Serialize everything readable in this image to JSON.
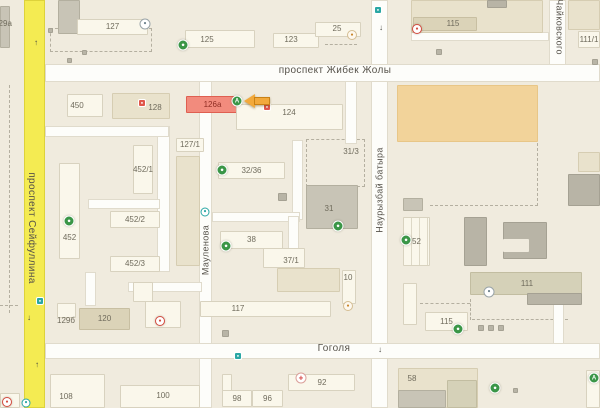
{
  "map": {
    "colors": {
      "background": "#f0ebde",
      "road_white": "#fdfdfa",
      "road_yellow": "#f4eb52",
      "building_white": "#faf7eb",
      "building_beige": "#e9e2cc",
      "building_gray": "#c8c4b6",
      "market_orange": "#f2d39a",
      "highlight_building": "#f28b7d",
      "highlight_arrow": "#f2a93b",
      "poi_green": "#3a9647",
      "poi_red": "#d44b3f",
      "poi_teal": "#2aa7a4"
    },
    "streets": [
      {
        "id": "zhibek-zholy",
        "text": "проспект Жибек Жолы",
        "x": 335,
        "y": 71,
        "orient": "h",
        "size": 10
      },
      {
        "id": "gogolya",
        "text": "Гоголя",
        "x": 334,
        "y": 349,
        "orient": "h",
        "size": 10
      },
      {
        "id": "seyfullina",
        "text": "проспект Сейфуллина",
        "x": 31,
        "y": 228,
        "orient": "v-down",
        "size": 10
      },
      {
        "id": "maulenova",
        "text": "Мауленова",
        "x": 206,
        "y": 250,
        "orient": "v-up",
        "size": 9
      },
      {
        "id": "nauryzbai-batyra",
        "text": "Наурызбай батыра",
        "x": 380,
        "y": 190,
        "orient": "v-up",
        "size": 9
      },
      {
        "id": "chaykovskogo",
        "text": "Чайковского",
        "x": 559,
        "y": 27,
        "orient": "v-down",
        "size": 9
      }
    ],
    "roads": [
      {
        "n": "maulenova",
        "t": "w",
        "x": 199,
        "y": 80,
        "w": 13,
        "h": 328
      },
      {
        "n": "lane-1",
        "t": "w",
        "x": 157,
        "y": 126,
        "w": 13,
        "h": 146
      },
      {
        "n": "lane-2",
        "t": "w",
        "x": 45,
        "y": 126,
        "w": 124,
        "h": 11
      },
      {
        "n": "lane-3",
        "t": "w",
        "x": 88,
        "y": 199,
        "w": 72,
        "h": 10
      },
      {
        "n": "lane-4",
        "t": "w",
        "x": 345,
        "y": 80,
        "w": 12,
        "h": 64
      },
      {
        "n": "lane-5",
        "t": "w",
        "x": 292,
        "y": 140,
        "w": 11,
        "h": 80
      },
      {
        "n": "lane-6",
        "t": "w",
        "x": 212,
        "y": 212,
        "w": 88,
        "h": 10
      },
      {
        "n": "lane-7",
        "t": "w",
        "x": 288,
        "y": 216,
        "w": 11,
        "h": 60
      },
      {
        "n": "lane-8",
        "t": "w",
        "x": 128,
        "y": 282,
        "w": 74,
        "h": 10
      },
      {
        "n": "lane-9",
        "t": "w",
        "x": 85,
        "y": 272,
        "w": 11,
        "h": 34
      },
      {
        "n": "lane-10",
        "t": "w",
        "x": 411,
        "y": 32,
        "w": 138,
        "h": 9
      },
      {
        "n": "lane-11",
        "t": "w",
        "x": 553,
        "y": 292,
        "w": 11,
        "h": 54
      },
      {
        "n": "chaykovskogo",
        "t": "w",
        "x": 549,
        "y": 0,
        "w": 17,
        "h": 68
      },
      {
        "n": "nauryzbai-batyra",
        "t": "w",
        "x": 371,
        "y": 0,
        "w": 17,
        "h": 408
      },
      {
        "n": "zhibek-zholy",
        "t": "w",
        "x": 45,
        "y": 64,
        "w": 555,
        "h": 18
      },
      {
        "n": "gogolya",
        "t": "w",
        "x": 45,
        "y": 343,
        "w": 555,
        "h": 16
      },
      {
        "n": "seyfullina",
        "t": "y",
        "x": 24,
        "y": 0,
        "w": 21,
        "h": 408
      }
    ],
    "dashes": [
      {
        "kind": "rect",
        "x": 50,
        "y": 28,
        "w": 102,
        "h": 24
      },
      {
        "kind": "rect",
        "x": 306,
        "y": 139,
        "w": 59,
        "h": 48
      },
      {
        "kind": "h",
        "x": 430,
        "y": 205,
        "w": 108
      },
      {
        "kind": "v",
        "x": 537,
        "y": 143,
        "h": 63
      },
      {
        "kind": "h",
        "x": 472,
        "y": 319,
        "w": 96
      },
      {
        "kind": "v",
        "x": 470,
        "y": 299,
        "h": 21
      },
      {
        "kind": "h",
        "x": 420,
        "y": 303,
        "w": 50
      },
      {
        "kind": "v",
        "x": 9,
        "y": 85,
        "h": 228
      },
      {
        "kind": "h",
        "x": 0,
        "y": 305,
        "w": 18
      },
      {
        "kind": "h",
        "x": 575,
        "y": 11,
        "w": 25
      },
      {
        "kind": "h",
        "x": 325,
        "y": 44,
        "w": 32
      }
    ],
    "buildings": [
      {
        "f": "g",
        "x": 58,
        "y": 0,
        "w": 22,
        "h": 34
      },
      {
        "f": "w",
        "x": 77,
        "y": 19,
        "w": 71,
        "h": 16,
        "label": "127"
      },
      {
        "f": "g",
        "x": 0,
        "y": 6,
        "w": 10,
        "h": 42,
        "label": "129а",
        "lx": 3,
        "ly": 24
      },
      {
        "f": "w",
        "x": 185,
        "y": 30,
        "w": 70,
        "h": 18,
        "label": "125",
        "lx": 207,
        "ly": 40
      },
      {
        "f": "w",
        "x": 273,
        "y": 33,
        "w": 46,
        "h": 15,
        "label": "123",
        "lx": 291,
        "ly": 40
      },
      {
        "f": "w",
        "x": 315,
        "y": 22,
        "w": 46,
        "h": 15,
        "label": "25",
        "lx": 337,
        "ly": 29
      },
      {
        "f": "b",
        "x": 411,
        "y": 0,
        "w": 132,
        "h": 33
      },
      {
        "f": "g2",
        "x": 487,
        "y": 0,
        "w": 20,
        "h": 8
      },
      {
        "f": "db",
        "x": 413,
        "y": 17,
        "w": 64,
        "h": 14,
        "label": "115",
        "lx": 453,
        "ly": 24
      },
      {
        "f": "b",
        "x": 568,
        "y": 0,
        "w": 32,
        "h": 30
      },
      {
        "f": "w",
        "x": 578,
        "y": 31,
        "w": 22,
        "h": 17,
        "label": "111/1"
      },
      {
        "f": "g2",
        "x": 436,
        "y": 49,
        "w": 6,
        "h": 6
      },
      {
        "f": "g2",
        "x": 592,
        "y": 59,
        "w": 6,
        "h": 6
      },
      {
        "f": "g2",
        "x": 48,
        "y": 28,
        "w": 5,
        "h": 5
      },
      {
        "f": "g2",
        "x": 82,
        "y": 50,
        "w": 5,
        "h": 5
      },
      {
        "f": "g2",
        "x": 67,
        "y": 58,
        "w": 5,
        "h": 5
      },
      {
        "f": "w",
        "x": 67,
        "y": 94,
        "w": 36,
        "h": 23,
        "label": "450",
        "lx": 77,
        "ly": 106
      },
      {
        "f": "b",
        "x": 112,
        "y": 93,
        "w": 58,
        "h": 26,
        "label": "128",
        "lx": 155,
        "ly": 108
      },
      {
        "f": "hl",
        "x": 186,
        "y": 96,
        "w": 53,
        "h": 17,
        "label": "126а"
      },
      {
        "f": "w",
        "x": 236,
        "y": 104,
        "w": 107,
        "h": 26,
        "label": "124",
        "lx": 289,
        "ly": 113
      },
      {
        "f": "w",
        "x": 133,
        "y": 145,
        "w": 20,
        "h": 49,
        "label": "452/1"
      },
      {
        "f": "w",
        "x": 110,
        "y": 211,
        "w": 50,
        "h": 17,
        "label": "452/2"
      },
      {
        "f": "w",
        "x": 59,
        "y": 163,
        "w": 21,
        "h": 96,
        "label": "452",
        "ly": 238
      },
      {
        "f": "w",
        "x": 110,
        "y": 256,
        "w": 50,
        "h": 16,
        "label": "452/3"
      },
      {
        "f": "w",
        "x": 176,
        "y": 138,
        "w": 28,
        "h": 14,
        "label": "127/1"
      },
      {
        "f": "b",
        "x": 176,
        "y": 156,
        "w": 24,
        "h": 110
      },
      {
        "f": "w",
        "x": 218,
        "y": 162,
        "w": 67,
        "h": 17,
        "label": "32/36"
      },
      {
        "f": "g",
        "x": 306,
        "y": 185,
        "w": 52,
        "h": 44,
        "label": "31",
        "lx": 329,
        "ly": 209
      },
      {
        "f": "w",
        "x": 220,
        "y": 231,
        "w": 63,
        "h": 18,
        "label": "38"
      },
      {
        "f": "w",
        "x": 263,
        "y": 248,
        "w": 42,
        "h": 20,
        "label": "37/1",
        "lx": 291,
        "ly": 261
      },
      {
        "f": "b",
        "x": 277,
        "y": 268,
        "w": 63,
        "h": 24
      },
      {
        "f": "g2",
        "x": 278,
        "y": 193,
        "w": 9,
        "h": 8
      },
      {
        "f": "o",
        "x": 397,
        "y": 85,
        "w": 141,
        "h": 57
      },
      {
        "f": "w",
        "x": 403,
        "y": 217,
        "w": 27,
        "h": 49,
        "label": "52",
        "stripes": true
      },
      {
        "f": "g",
        "x": 403,
        "y": 198,
        "w": 20,
        "h": 13
      },
      {
        "f": "g2",
        "x": 464,
        "y": 217,
        "w": 23,
        "h": 49
      },
      {
        "f": "g2",
        "x": 503,
        "y": 222,
        "w": 44,
        "h": 37
      },
      {
        "f": "bg",
        "x": 503,
        "y": 239,
        "w": 26,
        "h": 13
      },
      {
        "f": "b",
        "x": 578,
        "y": 152,
        "w": 22,
        "h": 20
      },
      {
        "f": "g2",
        "x": 568,
        "y": 174,
        "w": 32,
        "h": 32
      },
      {
        "f": "w",
        "x": 57,
        "y": 303,
        "w": 19,
        "h": 15
      },
      {
        "f": "db",
        "x": 79,
        "y": 308,
        "w": 51,
        "h": 22,
        "label": "120"
      },
      {
        "f": "w",
        "x": 133,
        "y": 282,
        "w": 20,
        "h": 20
      },
      {
        "f": "w",
        "x": 145,
        "y": 301,
        "w": 36,
        "h": 27
      },
      {
        "f": "w",
        "x": 50,
        "y": 374,
        "w": 55,
        "h": 34,
        "label": "108",
        "lx": 66,
        "ly": 397
      },
      {
        "f": "w",
        "x": 120,
        "y": 385,
        "w": 80,
        "h": 23,
        "label": "100",
        "lx": 163,
        "ly": 396
      },
      {
        "f": "w",
        "x": 0,
        "y": 393,
        "w": 20,
        "h": 15
      },
      {
        "f": "w",
        "x": 200,
        "y": 301,
        "w": 131,
        "h": 16,
        "label": "117",
        "lx": 238,
        "ly": 309
      },
      {
        "f": "w",
        "x": 342,
        "y": 270,
        "w": 14,
        "h": 34,
        "label": "10",
        "lx": 348,
        "ly": 278
      },
      {
        "f": "w",
        "x": 222,
        "y": 374,
        "w": 10,
        "h": 17
      },
      {
        "f": "w",
        "x": 222,
        "y": 390,
        "w": 30,
        "h": 17,
        "label": "98"
      },
      {
        "f": "w",
        "x": 252,
        "y": 390,
        "w": 31,
        "h": 17,
        "label": "96"
      },
      {
        "f": "w",
        "x": 288,
        "y": 374,
        "w": 67,
        "h": 17,
        "label": "92",
        "lx": 322,
        "ly": 383
      },
      {
        "f": "g2",
        "x": 222,
        "y": 330,
        "w": 7,
        "h": 7
      },
      {
        "f": "gb",
        "x": 470,
        "y": 272,
        "w": 112,
        "h": 23,
        "label": "111",
        "lx": 527,
        "ly": 284
      },
      {
        "f": "g2",
        "x": 527,
        "y": 293,
        "w": 55,
        "h": 12
      },
      {
        "f": "w",
        "x": 403,
        "y": 283,
        "w": 14,
        "h": 42
      },
      {
        "f": "w",
        "x": 425,
        "y": 312,
        "w": 43,
        "h": 19,
        "label": "115"
      },
      {
        "f": "g2",
        "x": 478,
        "y": 325,
        "w": 6,
        "h": 6
      },
      {
        "f": "g2",
        "x": 488,
        "y": 325,
        "w": 6,
        "h": 6
      },
      {
        "f": "g2",
        "x": 498,
        "y": 325,
        "w": 6,
        "h": 6
      },
      {
        "f": "b",
        "x": 398,
        "y": 368,
        "w": 80,
        "h": 40,
        "label": "58",
        "lx": 412,
        "ly": 379
      },
      {
        "f": "g",
        "x": 398,
        "y": 390,
        "w": 48,
        "h": 18
      },
      {
        "f": "gb",
        "x": 447,
        "y": 380,
        "w": 30,
        "h": 28
      },
      {
        "f": "w",
        "x": 586,
        "y": 370,
        "w": 14,
        "h": 38
      },
      {
        "f": "g2",
        "x": 513,
        "y": 388,
        "w": 5,
        "h": 5
      }
    ],
    "labels": [
      {
        "text": "31/3",
        "x": 351,
        "y": 152
      },
      {
        "text": "129б",
        "x": 66,
        "y": 321
      }
    ],
    "icons": [
      {
        "t": "green",
        "name": "pharmacy-icon",
        "g": "А",
        "x": 237,
        "y": 101
      },
      {
        "t": "green",
        "name": "poi-green-icon",
        "g": "●",
        "x": 183,
        "y": 45
      },
      {
        "t": "info",
        "name": "poi-icon",
        "g": "●",
        "x": 145,
        "y": 24
      },
      {
        "t": "amber",
        "name": "cafe-icon",
        "g": "●",
        "x": 352,
        "y": 35
      },
      {
        "t": "redpin",
        "name": "poi-red-icon",
        "g": "●",
        "x": 417,
        "y": 29
      },
      {
        "t": "redsq",
        "name": "poi-red-icon",
        "g": "●",
        "x": 142,
        "y": 103
      },
      {
        "t": "redsq",
        "name": "poi-red-icon",
        "g": "●",
        "x": 267,
        "y": 107
      },
      {
        "t": "tealsq",
        "name": "transit-stop-icon",
        "g": "●",
        "x": 378,
        "y": 10
      },
      {
        "t": "green",
        "name": "poi-green-icon",
        "g": "●",
        "x": 69,
        "y": 221
      },
      {
        "t": "green",
        "name": "poi-green-icon",
        "g": "●",
        "x": 222,
        "y": 170
      },
      {
        "t": "green",
        "name": "poi-green-icon",
        "g": "●",
        "x": 226,
        "y": 246
      },
      {
        "t": "green",
        "name": "poi-green-icon",
        "g": "●",
        "x": 338,
        "y": 226
      },
      {
        "t": "green",
        "name": "poi-green-icon",
        "g": "●",
        "x": 406,
        "y": 240
      },
      {
        "t": "tealc",
        "name": "transit-stop-icon",
        "g": "●",
        "x": 205,
        "y": 212
      },
      {
        "t": "tealsq",
        "name": "transit-stop-icon",
        "g": "●",
        "x": 40,
        "y": 301
      },
      {
        "t": "tealsq",
        "name": "transit-stop-icon",
        "g": "●",
        "x": 238,
        "y": 356
      },
      {
        "t": "tealc",
        "name": "transit-stop-icon",
        "g": "●",
        "x": 26,
        "y": 403
      },
      {
        "t": "redpin",
        "name": "poi-red-icon",
        "g": "●",
        "x": 160,
        "y": 321
      },
      {
        "t": "redpin",
        "name": "poi-red-icon",
        "g": "●",
        "x": 7,
        "y": 402
      },
      {
        "t": "amber",
        "name": "poi-icon",
        "g": "●",
        "x": 348,
        "y": 306
      },
      {
        "t": "med",
        "name": "medical-cross-icon",
        "g": "+",
        "x": 301,
        "y": 378
      },
      {
        "t": "info",
        "name": "poi-icon",
        "g": "●",
        "x": 489,
        "y": 292
      },
      {
        "t": "green",
        "name": "poi-green-icon",
        "g": "●",
        "x": 458,
        "y": 329
      },
      {
        "t": "green",
        "name": "pharmacy-icon",
        "g": "А",
        "x": 594,
        "y": 378
      },
      {
        "t": "green",
        "name": "poi-green-icon",
        "g": "●",
        "x": 495,
        "y": 388
      }
    ],
    "arrows": [
      {
        "g": "↑",
        "x": 36,
        "y": 43
      },
      {
        "g": "↓",
        "x": 29,
        "y": 318
      },
      {
        "g": "↑",
        "x": 37,
        "y": 365
      },
      {
        "g": "↓",
        "x": 381,
        "y": 28
      },
      {
        "g": "↓",
        "x": 380,
        "y": 350
      }
    ],
    "highlight_arrow": {
      "x": 244,
      "y": 94,
      "w": 27,
      "h": 15
    }
  }
}
